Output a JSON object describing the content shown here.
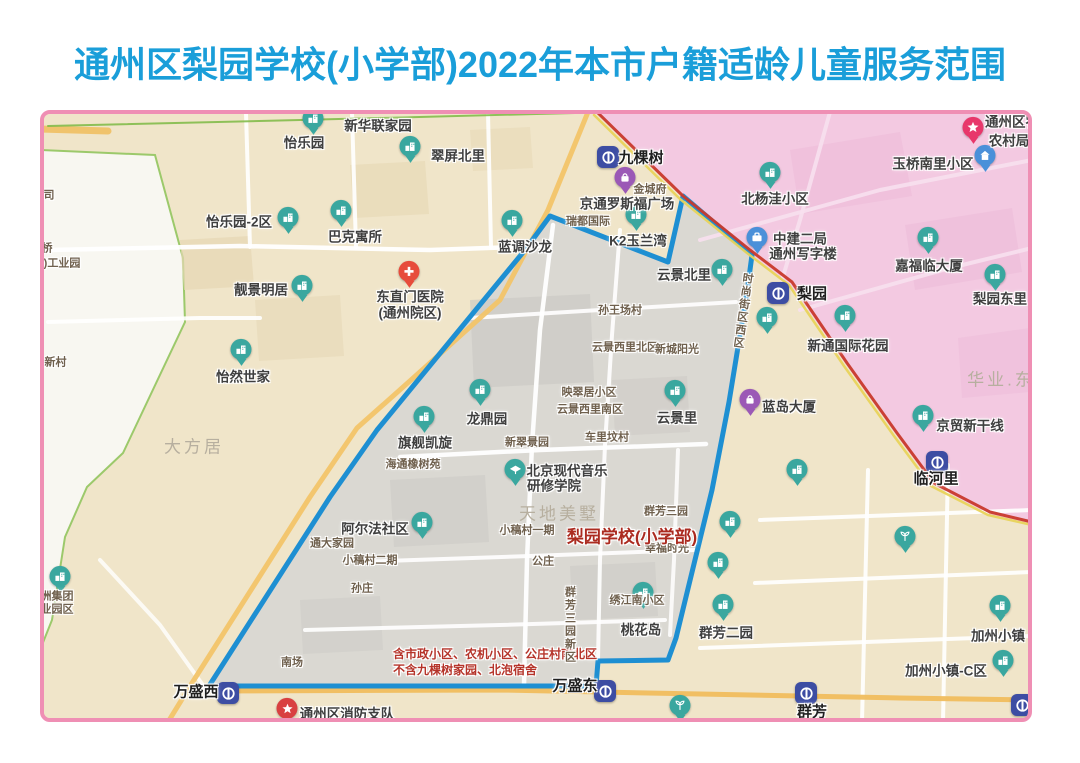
{
  "title": "通州区梨园学校(小学部)2022年本市户籍适龄儿童服务范围",
  "map": {
    "colors": {
      "base": "#f0e5c9",
      "frame": "#ef8fb4",
      "title_blue": "#1a9ed9",
      "service_fill": "#d8d7d2",
      "boundary_blue": "#1e8fd2",
      "pink_district": "#f3c9e1",
      "white_west": "#f8f7f1",
      "west_green": "#9cc96b",
      "red_road": "#c8392b",
      "yellow_line": "#e8d35b",
      "orange_road": "#f2c469",
      "teal_pin": "#3aa79f",
      "purple_pin": "#9b59b6",
      "blue_pin": "#4a90d9",
      "metro_blue": "#3d4da3",
      "red_label": "#ab2b20"
    },
    "regions": [
      {
        "n": "white-west-region",
        "pts": "40,150 155,155 183,258 185,322 123,453 87,487 65,537 52,620 40,650",
        "f": "#f8f7f1",
        "s": "#9cc96b",
        "sw": 2,
        "o": 1
      },
      {
        "n": "pink-district",
        "pts": "588,112 1032,112 1032,524 988,514 932,484 896,434 846,364 790,284 748,252 683,195 640,155 597,112",
        "f": "#f3c9e1",
        "o": 1
      },
      {
        "n": "pink-block",
        "pts": "790,150 900,132 912,196 800,214",
        "f": "#ecb9d8",
        "o": 0.55
      },
      {
        "n": "pink-block",
        "pts": "905,225 1012,208 1022,272 915,290",
        "f": "#ecb9d8",
        "o": 0.45
      },
      {
        "n": "pink-block",
        "pts": "958,338 1030,328 1030,392 962,398",
        "f": "#ecb9d8",
        "o": 0.4
      },
      {
        "n": "beige-block",
        "pts": "180,240 250,236 254,286 184,290",
        "f": "#e6d7b4",
        "o": 0.7
      },
      {
        "n": "beige-block",
        "pts": "350,165 425,161 429,214 354,218",
        "f": "#e6d7b4",
        "o": 0.6
      },
      {
        "n": "beige-block",
        "pts": "255,300 340,295 344,356 259,361",
        "f": "#e6d7b4",
        "o": 0.55
      },
      {
        "n": "beige-block",
        "pts": "470,130 530,127 533,168 473,171",
        "f": "#e6d7b4",
        "o": 0.5
      },
      {
        "n": "service-area-fill",
        "pts": "550,216 668,262 683,196 752,255 747,292 729,402 712,490 676,638 668,660 598,661 596,686 209,686 330,497 377,430 525,250",
        "f": "#d8d7d2",
        "o": 0.92
      },
      {
        "n": "gray-block",
        "pts": "470,300 590,294 594,382 474,388",
        "f": "#c9c8c3",
        "o": 0.6
      },
      {
        "n": "gray-block",
        "pts": "390,480 485,475 489,542 394,547",
        "f": "#c9c8c3",
        "o": 0.5
      },
      {
        "n": "gray-block",
        "pts": "570,566 655,562 658,616 573,620",
        "f": "#c9c8c3",
        "o": 0.5
      },
      {
        "n": "gray-block",
        "pts": "612,380 687,376 690,432 615,436",
        "f": "#c9c8c3",
        "o": 0.45
      },
      {
        "n": "gray-block",
        "pts": "300,600 380,596 383,650 303,654",
        "f": "#c9c8c3",
        "o": 0.4
      }
    ],
    "roads": [
      {
        "n": "road",
        "pts": "48,250 240,246 430,250 543,246",
        "c": "#ffffff",
        "w": 4.5,
        "o": 0.95
      },
      {
        "n": "road",
        "pts": "246,113 250,247",
        "c": "#ffffff",
        "w": 4,
        "o": 0.9
      },
      {
        "n": "road",
        "pts": "352,113 356,247",
        "c": "#ffffff",
        "w": 4,
        "o": 0.9
      },
      {
        "n": "road",
        "pts": "488,113 491,247",
        "c": "#ffffff",
        "w": 4,
        "o": 0.9
      },
      {
        "n": "road",
        "pts": "48,322 200,318 260,318",
        "c": "#ffffff",
        "w": 4,
        "o": 0.9
      },
      {
        "n": "road",
        "pts": "100,560 160,625 205,688",
        "c": "#ffffff",
        "w": 4,
        "o": 0.8
      },
      {
        "n": "road",
        "pts": "553,225 540,330 532,445 527,560 524,686",
        "c": "#ffffff",
        "w": 4.5,
        "o": 0.95
      },
      {
        "n": "road",
        "pts": "620,230 612,335 605,445 600,560 598,660",
        "c": "#ffffff",
        "w": 4,
        "o": 0.9
      },
      {
        "n": "road",
        "pts": "470,318 600,310 736,302",
        "c": "#ffffff",
        "w": 4,
        "o": 0.9
      },
      {
        "n": "road",
        "pts": "400,457 540,450 706,444",
        "c": "#ffffff",
        "w": 4.5,
        "o": 0.95
      },
      {
        "n": "road",
        "pts": "357,562 530,556 695,550",
        "c": "#ffffff",
        "w": 4,
        "o": 0.9
      },
      {
        "n": "road",
        "pts": "305,630 500,625 665,620",
        "c": "#ffffff",
        "w": 4,
        "o": 0.9
      },
      {
        "n": "road",
        "pts": "678,450 674,560 670,635",
        "c": "#ffffff",
        "w": 4,
        "o": 0.85
      },
      {
        "n": "road",
        "pts": "868,470 862,722",
        "c": "#ffffff",
        "w": 4,
        "o": 0.9
      },
      {
        "n": "road",
        "pts": "948,465 943,722",
        "c": "#ffffff",
        "w": 4,
        "o": 0.9
      },
      {
        "n": "road",
        "pts": "760,520 1032,510",
        "c": "#ffffff",
        "w": 4,
        "o": 0.9
      },
      {
        "n": "road",
        "pts": "755,583 1032,572",
        "c": "#ffffff",
        "w": 4,
        "o": 0.9
      },
      {
        "n": "road",
        "pts": "700,648 1032,636",
        "c": "#ffffff",
        "w": 4,
        "o": 0.9
      },
      {
        "n": "road-pink",
        "pts": "830,112 800,220 782,280",
        "c": "#f7e0ee",
        "w": 4,
        "o": 0.9
      },
      {
        "n": "road-pink",
        "pts": "700,240 880,190 1032,160",
        "c": "#f7e0ee",
        "w": 4,
        "o": 0.9
      },
      {
        "n": "road-pink",
        "pts": "800,310 950,268 1032,248",
        "c": "#f7e0ee",
        "w": 4,
        "o": 0.9
      },
      {
        "n": "road-orange",
        "pts": "40,129 108,131",
        "c": "#f0bf62",
        "w": 7,
        "o": 0.9
      },
      {
        "n": "road-orange-diagonal",
        "pts": "588,112 548,210 500,300 411,380 357,428 310,497 192,683 168,722",
        "c": "#f2c469",
        "w": 5,
        "o": 0.95
      },
      {
        "n": "road-orange-bottom",
        "pts": "205,691 500,690 700,694 900,698 1032,700",
        "c": "#f0bd5e",
        "w": 5,
        "o": 0.95
      },
      {
        "n": "green-boundary-line",
        "pts": "48,126 300,120 575,113",
        "c": "#83bb4b",
        "w": 2,
        "o": 0.9
      }
    ],
    "boundary": {
      "n": "service-area-boundary",
      "pts": "550,216 668,262 683,196 752,255 747,292 729,402 712,490 676,638 668,660 598,661 596,686 209,686 330,497 377,430 525,250",
      "c": "#1e8fd2",
      "w": 5
    },
    "top_roads": [
      {
        "n": "rail-yellow-line",
        "pts": "594,115 640,160 680,199 747,253 789,285 844,366 894,436 931,486 988,515 1032,525",
        "c": "#e8d35b",
        "w": 2.5,
        "o": 0.95
      },
      {
        "n": "rail-red-line",
        "pts": "597,112 643,157 683,196 750,250 792,282 847,363 897,433 934,483 990,512 1032,522",
        "c": "#c8392b",
        "w": 3,
        "o": 0.95
      }
    ],
    "icons": [
      {
        "t": "metro",
        "name": "jiukeshu-station",
        "x": 608,
        "y": 157
      },
      {
        "t": "metro",
        "name": "liyuan-station",
        "x": 778,
        "y": 293
      },
      {
        "t": "metro",
        "name": "linheli-station",
        "x": 937,
        "y": 462
      },
      {
        "t": "metro",
        "name": "wanshengxi-station",
        "x": 228,
        "y": 693
      },
      {
        "t": "metro",
        "name": "wanshengdong-station",
        "x": 605,
        "y": 691
      },
      {
        "t": "metro",
        "name": "qunfang-station",
        "x": 806,
        "y": 693
      },
      {
        "t": "metro",
        "name": "metro-station",
        "x": 1022,
        "y": 705
      },
      {
        "t": "residence",
        "x": 313,
        "y": 123
      },
      {
        "t": "residence",
        "x": 410,
        "y": 151
      },
      {
        "t": "residence",
        "x": 288,
        "y": 222
      },
      {
        "t": "residence",
        "x": 341,
        "y": 215
      },
      {
        "t": "residence",
        "x": 512,
        "y": 225
      },
      {
        "t": "residence",
        "x": 302,
        "y": 290
      },
      {
        "t": "residence",
        "x": 241,
        "y": 354
      },
      {
        "t": "residence",
        "x": 480,
        "y": 394
      },
      {
        "t": "residence",
        "x": 424,
        "y": 421
      },
      {
        "t": "residence",
        "x": 422,
        "y": 527
      },
      {
        "t": "residence",
        "x": 722,
        "y": 274
      },
      {
        "t": "residence",
        "x": 675,
        "y": 395
      },
      {
        "t": "residence",
        "x": 636,
        "y": 219
      },
      {
        "t": "residence",
        "x": 643,
        "y": 597
      },
      {
        "t": "residence",
        "x": 723,
        "y": 609
      },
      {
        "t": "residence",
        "x": 1000,
        "y": 610
      },
      {
        "t": "residence",
        "x": 1003,
        "y": 665
      },
      {
        "t": "residence",
        "x": 770,
        "y": 177
      },
      {
        "t": "residence",
        "x": 928,
        "y": 242
      },
      {
        "t": "residence",
        "x": 995,
        "y": 279
      },
      {
        "t": "residence",
        "x": 845,
        "y": 320
      },
      {
        "t": "residence",
        "x": 923,
        "y": 420
      },
      {
        "t": "residence",
        "x": 767,
        "y": 322
      },
      {
        "t": "residence",
        "x": 797,
        "y": 474
      },
      {
        "t": "residence",
        "x": 730,
        "y": 526
      },
      {
        "t": "residence",
        "x": 718,
        "y": 567
      },
      {
        "t": "residence",
        "x": 60,
        "y": 581
      },
      {
        "t": "bluehouse",
        "name": "yuqiaonanli-pin",
        "x": 985,
        "y": 160
      },
      {
        "t": "office",
        "name": "zhongjian-office-pin",
        "x": 757,
        "y": 242
      },
      {
        "t": "mall",
        "name": "jinchengfu-pin",
        "x": 625,
        "y": 182
      },
      {
        "t": "mall",
        "name": "landao-mall-pin",
        "x": 750,
        "y": 404
      },
      {
        "t": "school",
        "name": "music-college-pin",
        "x": 515,
        "y": 474
      },
      {
        "t": "plant",
        "x": 905,
        "y": 541
      },
      {
        "t": "plant",
        "x": 680,
        "y": 710
      },
      {
        "t": "hospital",
        "name": "hospital-pin",
        "x": 409,
        "y": 276
      },
      {
        "t": "fire",
        "name": "fire-brigade-pin",
        "x": 287,
        "y": 713
      },
      {
        "t": "star",
        "name": "rural-bureau-pin",
        "x": 973,
        "y": 132
      }
    ],
    "labels": [
      {
        "text": "怡乐园",
        "x": 304,
        "y": 143
      },
      {
        "text": "新华联家园",
        "x": 378,
        "y": 126
      },
      {
        "text": "翠屏北里",
        "x": 458,
        "y": 156
      },
      {
        "text": "怡乐园-2区",
        "x": 239,
        "y": 222
      },
      {
        "text": "巴克寓所",
        "x": 355,
        "y": 237
      },
      {
        "text": "蓝调沙龙",
        "x": 525,
        "y": 247
      },
      {
        "text": "靓景明居",
        "x": 261,
        "y": 290
      },
      {
        "text": "怡然世家",
        "x": 243,
        "y": 377
      },
      {
        "text": "东直门医院",
        "x": 410,
        "y": 297
      },
      {
        "text": "(通州院区)",
        "x": 410,
        "y": 313
      },
      {
        "text": "龙鼎园",
        "x": 487,
        "y": 419
      },
      {
        "text": "旗舰凯旋",
        "x": 425,
        "y": 443
      },
      {
        "text": "阿尔法社区",
        "x": 375,
        "y": 529
      },
      {
        "text": "北京现代音乐",
        "x": 567,
        "y": 471
      },
      {
        "text": "研修学院",
        "x": 554,
        "y": 486
      },
      {
        "text": "云景北里",
        "x": 684,
        "y": 275
      },
      {
        "text": "云景里",
        "x": 677,
        "y": 418
      },
      {
        "text": "K2玉兰湾",
        "x": 638,
        "y": 241
      },
      {
        "text": "京通罗斯福广场",
        "x": 627,
        "y": 204
      },
      {
        "text": "桃花岛",
        "x": 641,
        "y": 630
      },
      {
        "text": "群芳二园",
        "x": 726,
        "y": 633
      },
      {
        "text": "加州小镇",
        "x": 998,
        "y": 636
      },
      {
        "text": "加州小镇-C区",
        "x": 946,
        "y": 671
      },
      {
        "text": "玉桥南里小区",
        "x": 933,
        "y": 164
      },
      {
        "text": "北杨洼小区",
        "x": 775,
        "y": 199
      },
      {
        "text": "中建二局",
        "x": 800,
        "y": 239
      },
      {
        "text": "通州写字楼",
        "x": 803,
        "y": 254
      },
      {
        "text": "嘉福临大厦",
        "x": 929,
        "y": 266
      },
      {
        "text": "梨园东里",
        "x": 1000,
        "y": 299
      },
      {
        "text": "新通国际花园",
        "x": 848,
        "y": 346
      },
      {
        "text": "京贸新干线",
        "x": 970,
        "y": 426
      },
      {
        "text": "蓝岛大厦",
        "x": 789,
        "y": 407
      },
      {
        "text": "通州区消防支队",
        "x": 347,
        "y": 714
      },
      {
        "text": "通州区农",
        "x": 1012,
        "y": 122
      },
      {
        "text": "农村局",
        "x": 1009,
        "y": 141
      },
      {
        "text": "九棵树",
        "x": 641,
        "y": 158,
        "k": "sta"
      },
      {
        "text": "梨园",
        "x": 812,
        "y": 294,
        "k": "sta"
      },
      {
        "text": "临河里",
        "x": 936,
        "y": 479,
        "k": "sta"
      },
      {
        "text": "万盛西",
        "x": 196,
        "y": 692,
        "k": "sta"
      },
      {
        "text": "万盛东",
        "x": 575,
        "y": 686,
        "k": "sta"
      },
      {
        "text": "群芳",
        "x": 812,
        "y": 712,
        "k": "sta"
      },
      {
        "text": "金城府",
        "x": 650,
        "y": 190,
        "k": "sm"
      },
      {
        "text": "瑞都国际",
        "x": 588,
        "y": 222,
        "k": "sm"
      },
      {
        "text": "孙王场村",
        "x": 620,
        "y": 311,
        "k": "sm"
      },
      {
        "text": "云景西里北区",
        "x": 625,
        "y": 348,
        "k": "sm"
      },
      {
        "text": "新城阳光",
        "x": 677,
        "y": 350,
        "k": "sm"
      },
      {
        "text": "映翠居小区",
        "x": 589,
        "y": 393,
        "k": "sm"
      },
      {
        "text": "云景西里南区",
        "x": 590,
        "y": 410,
        "k": "sm"
      },
      {
        "text": "车里坟村",
        "x": 607,
        "y": 438,
        "k": "sm"
      },
      {
        "text": "新翠景园",
        "x": 527,
        "y": 443,
        "k": "sm"
      },
      {
        "text": "海通橡树苑",
        "x": 413,
        "y": 465,
        "k": "sm"
      },
      {
        "text": "小稿村一期",
        "x": 527,
        "y": 531,
        "k": "sm"
      },
      {
        "text": "群芳三园",
        "x": 666,
        "y": 512,
        "k": "sm"
      },
      {
        "text": "幸福时光",
        "x": 667,
        "y": 549,
        "k": "sm"
      },
      {
        "text": "通大家园",
        "x": 332,
        "y": 544,
        "k": "sm"
      },
      {
        "text": "小稿村二期",
        "x": 370,
        "y": 561,
        "k": "sm"
      },
      {
        "text": "孙庄",
        "x": 362,
        "y": 589,
        "k": "sm"
      },
      {
        "text": "公庄",
        "x": 543,
        "y": 562,
        "k": "sm"
      },
      {
        "text": "南场",
        "x": 292,
        "y": 663,
        "k": "sm"
      },
      {
        "text": "绣江南小区",
        "x": 637,
        "y": 601,
        "k": "sm"
      },
      {
        "text": "旦新村",
        "x": 50,
        "y": 363,
        "k": "sm"
      },
      {
        "text": "司",
        "x": 49,
        "y": 196,
        "k": "sm"
      },
      {
        "text": "桥",
        "x": 47,
        "y": 249,
        "k": "sm"
      },
      {
        "text": ")工业园",
        "x": 62,
        "y": 264,
        "k": "sm"
      },
      {
        "text": "洲集团",
        "x": 57,
        "y": 597,
        "k": "sm"
      },
      {
        "text": "业园区",
        "x": 57,
        "y": 610,
        "k": "sm"
      },
      {
        "text": "大方居",
        "x": 194,
        "y": 447,
        "k": "big"
      },
      {
        "text": "天地美墅",
        "x": 559,
        "y": 514,
        "k": "big"
      },
      {
        "text": "华业.东",
        "x": 1001,
        "y": 380,
        "k": "big"
      },
      {
        "text": "梨园学校(小学部)",
        "x": 632,
        "y": 537,
        "k": "red",
        "n": "school-name-label"
      },
      {
        "text": "含市政小区、农机小区、公庄村南北区",
        "x": 393,
        "y": 654,
        "k": "note",
        "n": "service-note-line1"
      },
      {
        "text": "不含九棵树家园、北泡宿舍",
        "x": 393,
        "y": 670,
        "k": "note",
        "n": "service-note-line2"
      },
      {
        "text": "时尚街区西区",
        "x": 742,
        "y": 272,
        "k": "sm v",
        "rot": 8,
        "n": "street-block-label"
      },
      {
        "text": "群芳三园新区",
        "x": 569,
        "y": 586,
        "k": "sm v",
        "n": "qunfang-new-label"
      }
    ]
  }
}
